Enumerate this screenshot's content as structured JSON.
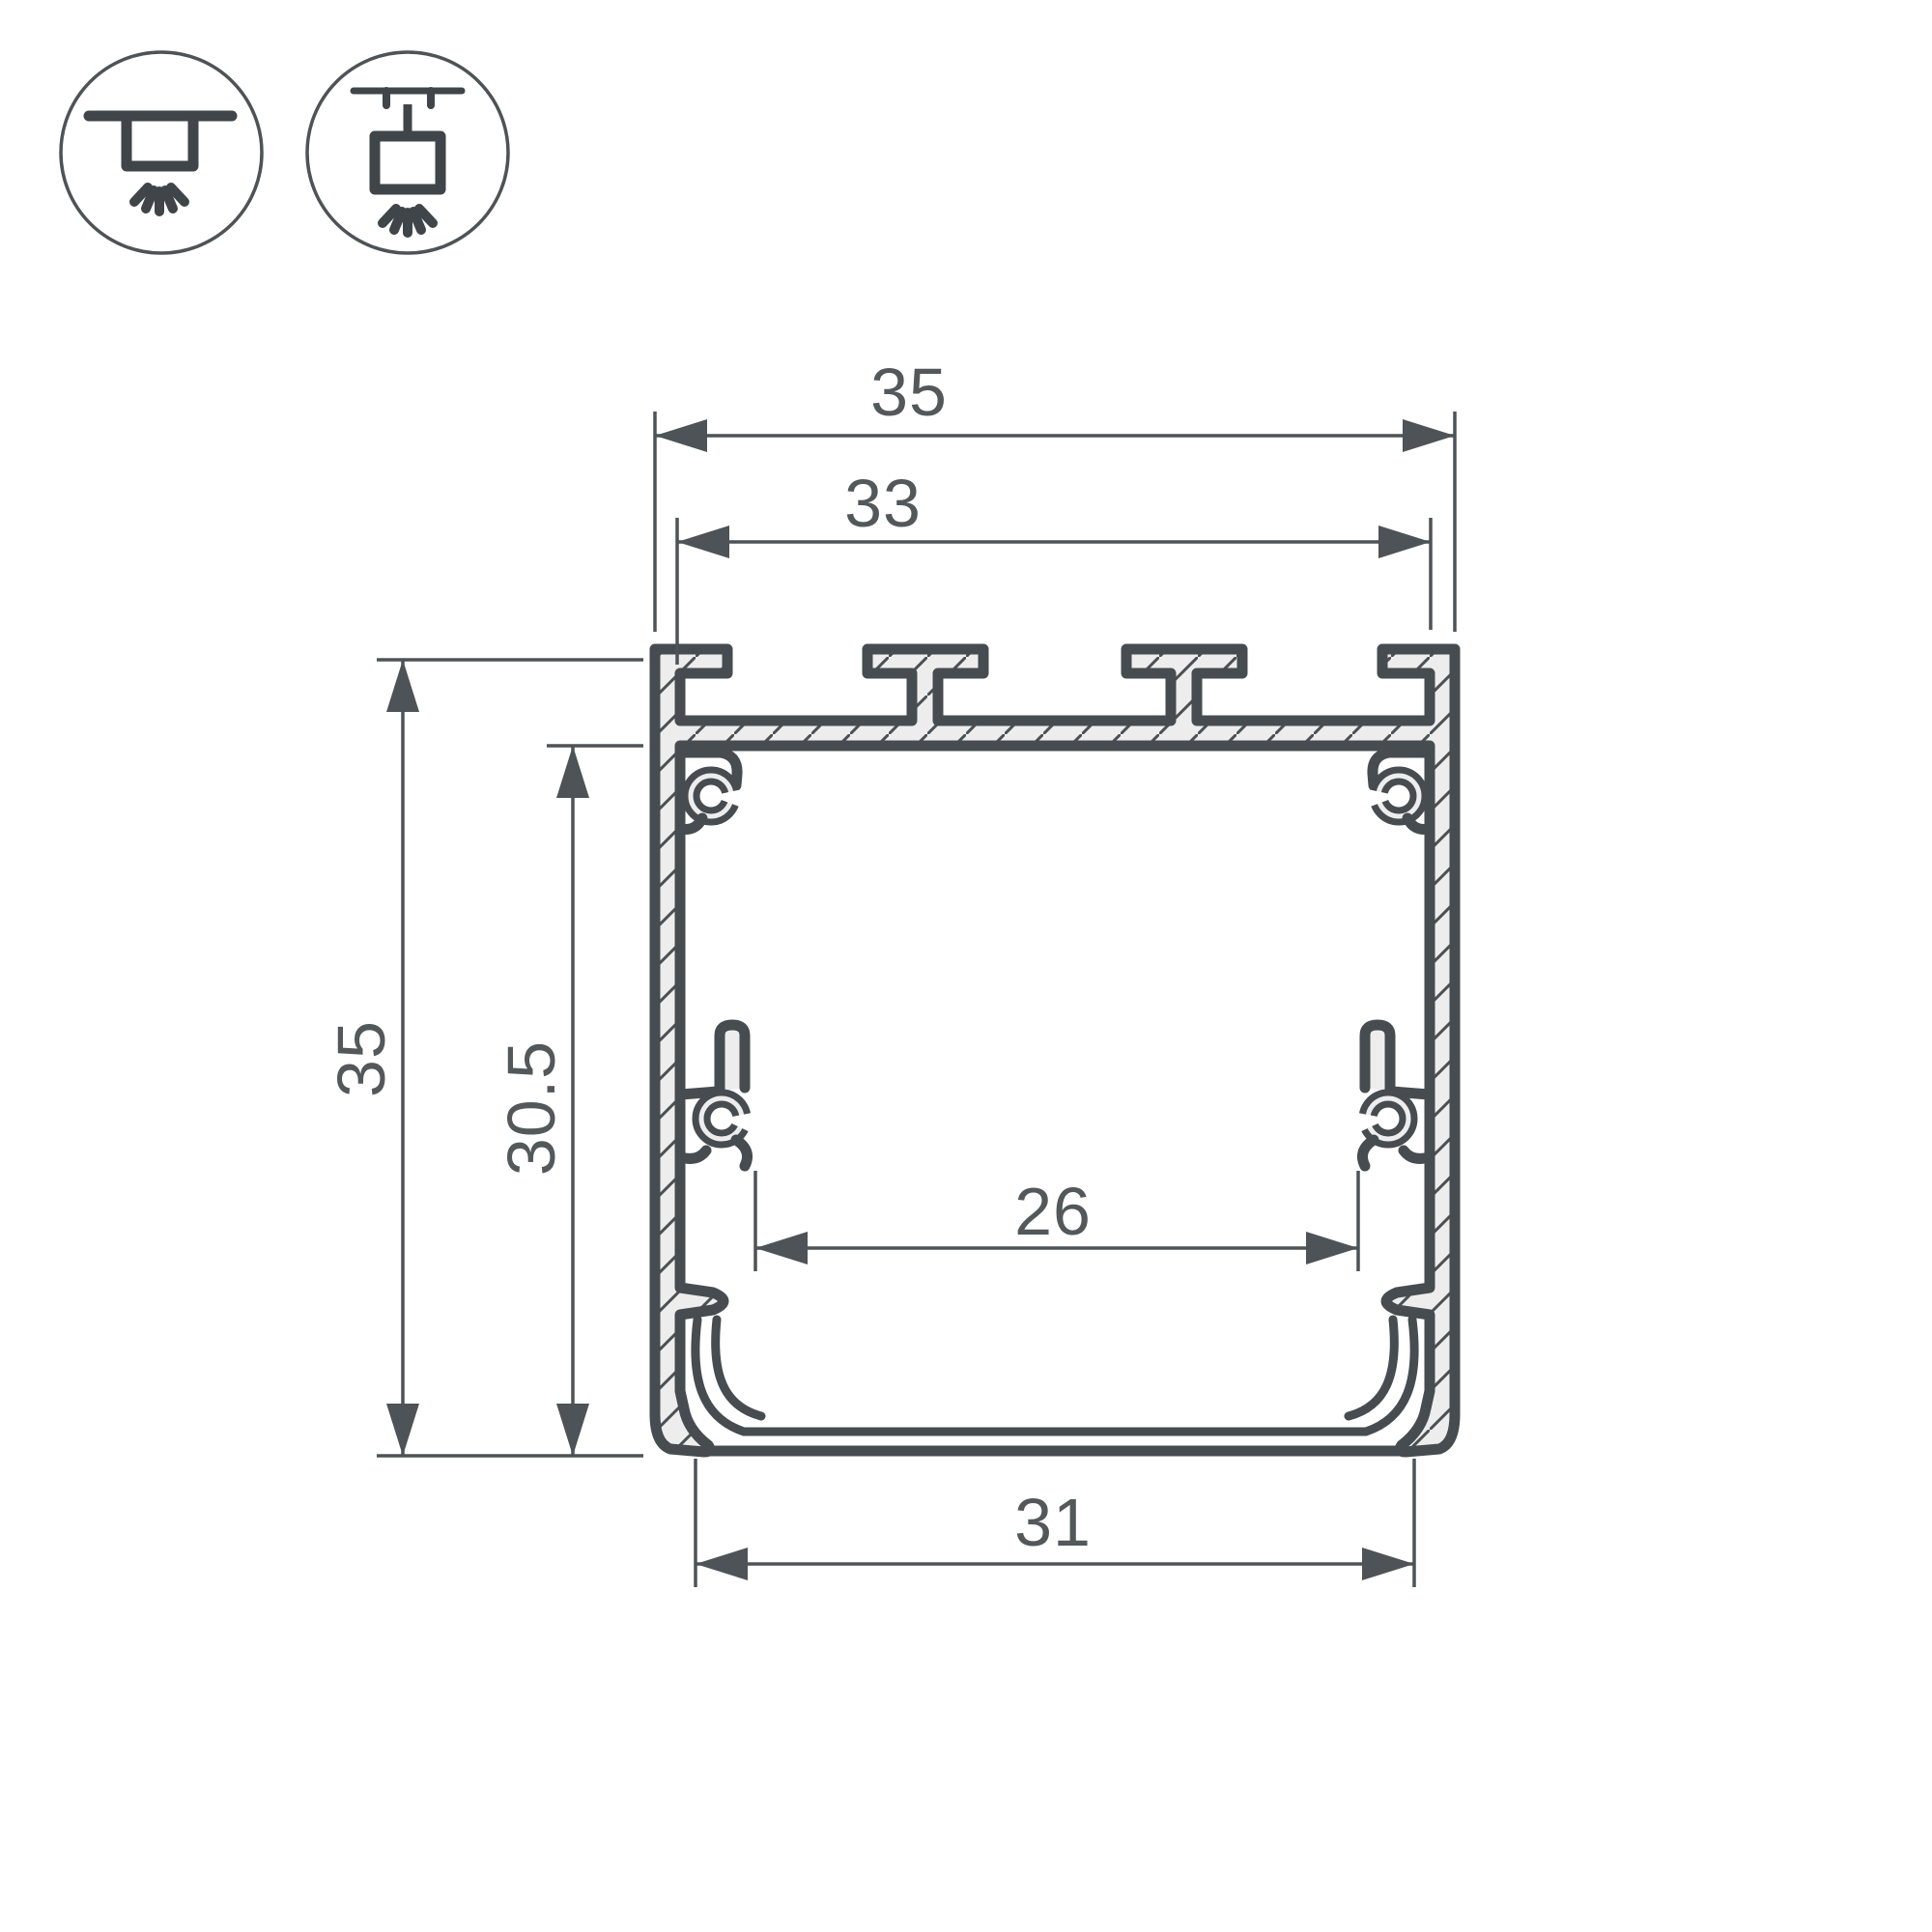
{
  "drawing": {
    "kind": "aluminum-led-profile-cross-section",
    "colors": {
      "outline": "#464c4f",
      "dimension": "#4d5356",
      "metal_fill": "#ededee",
      "label_text": "#53585b",
      "background": "#ffffff"
    }
  },
  "icons": {
    "surface": {
      "name": "surface-mount-light-icon"
    },
    "pendant": {
      "name": "suspended-mount-light-icon"
    }
  },
  "dimensions": {
    "overall_width": {
      "label": "35"
    },
    "top_slot_width": {
      "label": "33"
    },
    "overall_height": {
      "label": "35"
    },
    "inner_height": {
      "label": "30.5"
    },
    "inner_width": {
      "label": "26"
    },
    "bottom_width": {
      "label": "31"
    }
  }
}
